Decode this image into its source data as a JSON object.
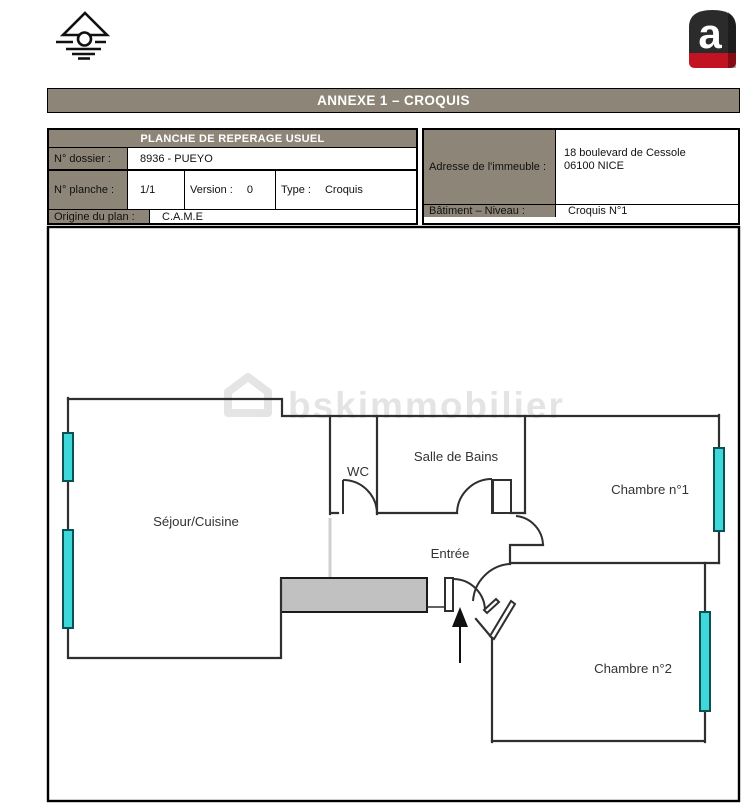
{
  "header": {
    "brand_letter": "a",
    "banner_title": "ANNEXE 1 – CROQUIS"
  },
  "reperage_table": {
    "title": "PLANCHE DE REPERAGE USUEL",
    "dossier_label": "N° dossier :",
    "dossier_value": "8936 - PUEYO",
    "planche_label": "N° planche :",
    "planche_value": "1/1",
    "version_label": "Version :",
    "version_value": "0",
    "type_label": "Type :",
    "type_value": "Croquis",
    "origine_label": "Origine du plan :",
    "origine_value": "C.A.M.E"
  },
  "address_table": {
    "address_label": "Adresse de l'immeuble :",
    "address_line1": "18 boulevard de Cessole",
    "address_line2": "06100 NICE",
    "batiment_label": "Bâtiment – Niveau :",
    "batiment_value": "Croquis N°1"
  },
  "plan": {
    "watermark": "bskimmobilier",
    "rooms": {
      "sejour": "Séjour/Cuisine",
      "wc": "WC",
      "sdb": "Salle de Bains",
      "entree": "Entrée",
      "ch1": "Chambre n°1",
      "ch2": "Chambre n°2"
    },
    "colors": {
      "taupe_accent": "#8d8678",
      "wall": "#2f2f2f",
      "window_fill": "#3fd8da",
      "window_border": "#0b5053",
      "closet_fill": "#c1c1c1",
      "logo_dark": "#2b2b2b",
      "logo_red": "#c11322"
    }
  }
}
